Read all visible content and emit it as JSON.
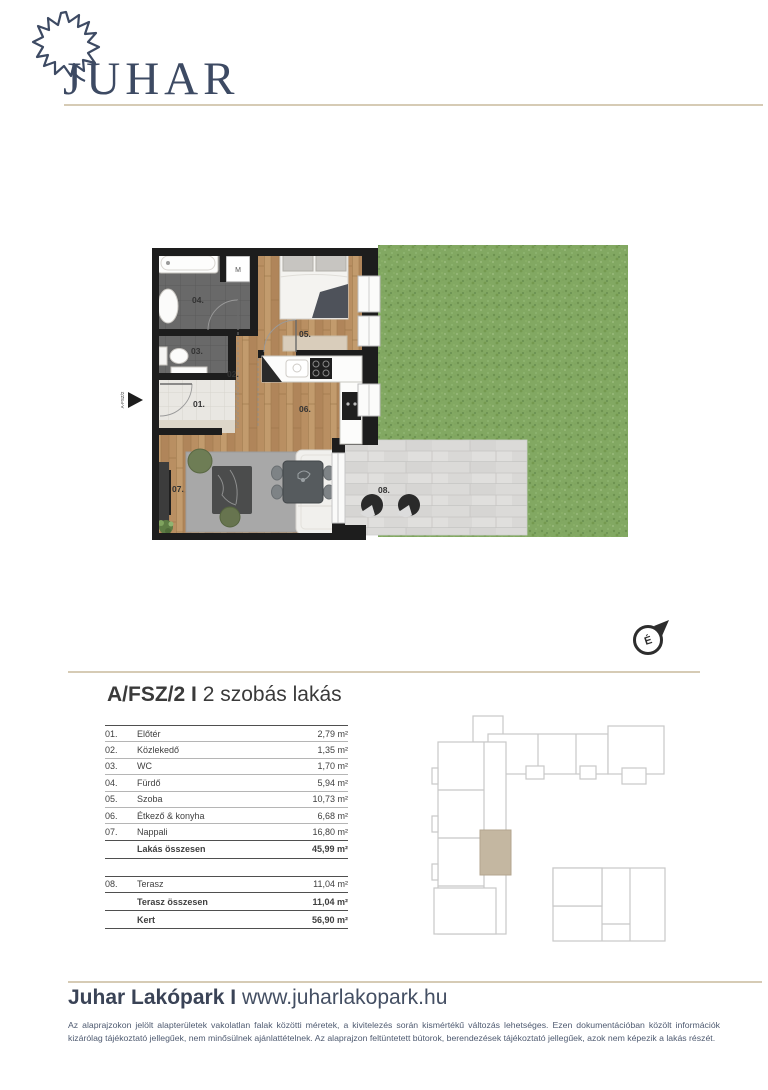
{
  "logo": {
    "brand": "JUHAR",
    "leaf_icon": "maple-leaf-outline"
  },
  "unit_header": {
    "code": "A/FSZ/2",
    "separator": "I",
    "type": "2 szobás lakás"
  },
  "floor_plan": {
    "labels": {
      "r01": "01.",
      "r02": "02.",
      "r03": "03.",
      "r04": "04.",
      "r05": "05.",
      "r06": "06.",
      "r07": "07.",
      "r08": "08.",
      "machine": "M",
      "compass": "É",
      "entrance_tag": "A-FSZ/2"
    }
  },
  "area_table": {
    "rows": [
      {
        "num": "01.",
        "name": "Előtér",
        "value": "2,79 m²"
      },
      {
        "num": "02.",
        "name": "Közlekedő",
        "value": "1,35 m²"
      },
      {
        "num": "03.",
        "name": "WC",
        "value": "1,70 m²"
      },
      {
        "num": "04.",
        "name": "Fürdő",
        "value": "5,94 m²"
      },
      {
        "num": "05.",
        "name": "Szoba",
        "value": "10,73 m²"
      },
      {
        "num": "06.",
        "name": "Étkező & konyha",
        "value": "6,68 m²"
      },
      {
        "num": "07.",
        "name": "Nappali",
        "value": "16,80 m²"
      }
    ],
    "apartment_total": {
      "name": "Lakás összesen",
      "value": "45,99 m²"
    },
    "terrace_rows": [
      {
        "num": "08.",
        "name": "Terasz",
        "value": "11,04 m²"
      }
    ],
    "terrace_total": {
      "name": "Terasz összesen",
      "value": "11,04 m²"
    },
    "garden_total": {
      "name": "Kert",
      "value": "56,90 m²"
    }
  },
  "footer": {
    "brand": "Juhar Lakópark",
    "separator": "I",
    "website": "www.juharlakopark.hu",
    "disclaimer": "Az alaprajzokon jelölt alapterületek vakolatlan falak közötti méretek, a kivitelezés során kismértékű változás lehetséges. Ezen dokumentációban közölt információk kizárólag tájékoztató jellegűek, nem minősülnek ajánlattételnek. Az alaprajzon feltüntetett bútorok, berendezések tájékoztató jellegűek, azok nem képezik a lakás részét."
  },
  "colors": {
    "navy": "#3d4a63",
    "beige_line": "#d6cbb5",
    "text_dark": "#3f3f3f",
    "wall": "#1d1d1d",
    "grass": "#82a862",
    "wood": "#bb9365",
    "highlight_unit": "#c4b7a1"
  }
}
